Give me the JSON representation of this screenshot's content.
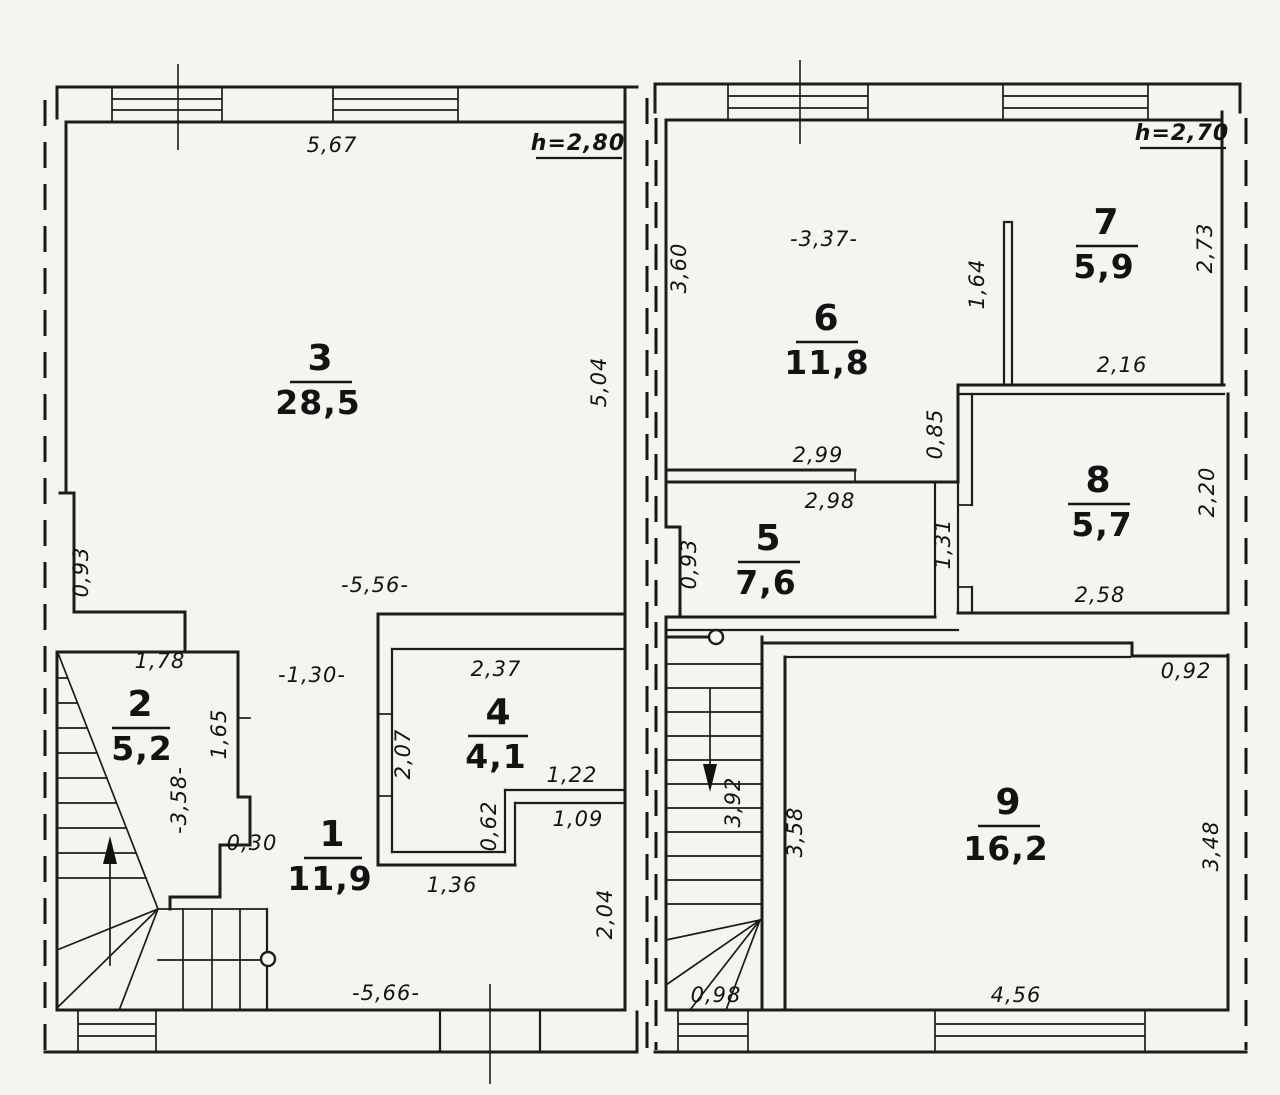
{
  "left_floor": {
    "height_label": "h=2,80",
    "rooms": {
      "r1": {
        "number": "1",
        "area": "11,9"
      },
      "r2": {
        "number": "2",
        "area": "5,2"
      },
      "r3": {
        "number": "3",
        "area": "28,5"
      },
      "r4": {
        "number": "4",
        "area": "4,1"
      }
    },
    "dims": {
      "top": "5,67",
      "right_upper": "5,04",
      "left_upper": "0,93",
      "interior_width": "-5,56-",
      "room2_top": "1,78",
      "gap_room2_room4": "-1,30-",
      "room2_right": "1,65",
      "room2_depth": "-3,58-",
      "step": "0,30",
      "room4_top": "2,37",
      "room4_left": "2,07",
      "notch_top": "1,22",
      "notch_left": "0,62",
      "nook_width": "1,09",
      "room4_bottom": "1,36",
      "right_lower": "2,04",
      "bottom": "-5,66-"
    }
  },
  "right_floor": {
    "height_label": "h=2,70",
    "rooms": {
      "r5": {
        "number": "5",
        "area": "7,6"
      },
      "r6": {
        "number": "6",
        "area": "11,8"
      },
      "r7": {
        "number": "7",
        "area": "5,9"
      },
      "r8": {
        "number": "8",
        "area": "5,7"
      },
      "r9": {
        "number": "9",
        "area": "16,2"
      }
    },
    "dims": {
      "room6_left": "3,60",
      "room6_width": "-3,37-",
      "partition_6_7": "1,64",
      "room7_right": "2,73",
      "room7_bottom": "2,16",
      "wall_step": "0,85",
      "room6_bottom": "2,99",
      "room5_top": "2,98",
      "room5_left": "0,93",
      "room5_right": "1,31",
      "room8_right": "2,20",
      "room8_bottom": "2,58",
      "room9_top_notch": "0,92",
      "stairs_length": "3,92",
      "room9_left": "3,58",
      "room9_right": "3,48",
      "room9_bottom": "4,56",
      "stairs_width": "0,98"
    }
  }
}
